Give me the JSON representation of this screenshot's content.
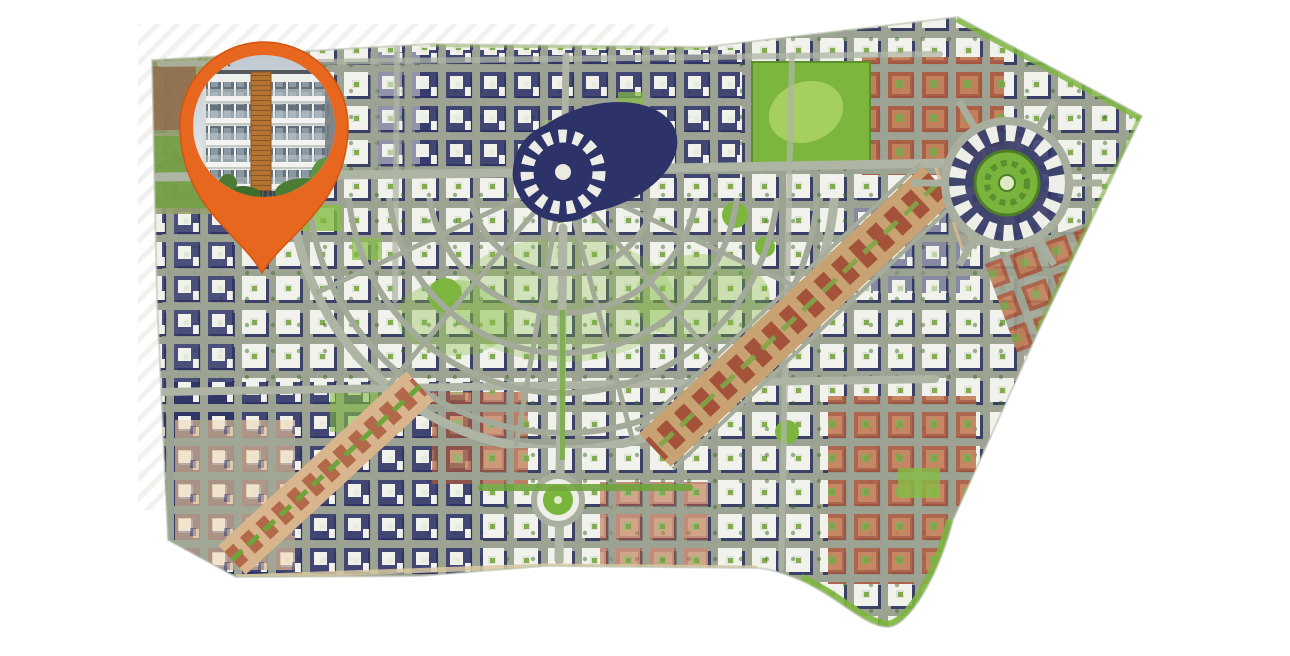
{
  "page": {
    "background": "#FFFFFF",
    "kind": "property-location-map-figure"
  },
  "marker": {
    "id": "property-location-pin",
    "shape": "map-pin",
    "ring_color": "#E8671E",
    "ring_edge_color": "#D4550F",
    "photo_subject": "apartment-building-exterior-render",
    "aria_label": "Property location pin showing apartment building photo"
  },
  "map": {
    "kind": "aerial-masterplan-city-map",
    "aria_label": "Master plan aerial city map with location pin in the north-west district",
    "palette": {
      "street": "#9CA393",
      "avenue": "#AFB5A5",
      "block_white": "#F1F2EC",
      "block_navy": "#2E3366",
      "block_brick": "#A7573D",
      "block_brick_light": "#C07B55",
      "block_tan": "#DEB992",
      "green_bright": "#86BD45",
      "green_park": "#7DB63E",
      "green_dark": "#4E7D28",
      "plaza_navy": "#2D3269",
      "boulevard_tan": "#C9A273",
      "sand": "#D9C9A2",
      "hatch": "#EDEDEA"
    },
    "features": [
      {
        "id": "central-plaza"
      },
      {
        "id": "radial-fan-district"
      },
      {
        "id": "grand-diagonal-boulevard"
      },
      {
        "id": "southwest-boulevard"
      },
      {
        "id": "east-roundabout"
      },
      {
        "id": "north-park"
      },
      {
        "id": "pocket-circle-plaza"
      },
      {
        "id": "neighborhood-grid"
      }
    ]
  }
}
